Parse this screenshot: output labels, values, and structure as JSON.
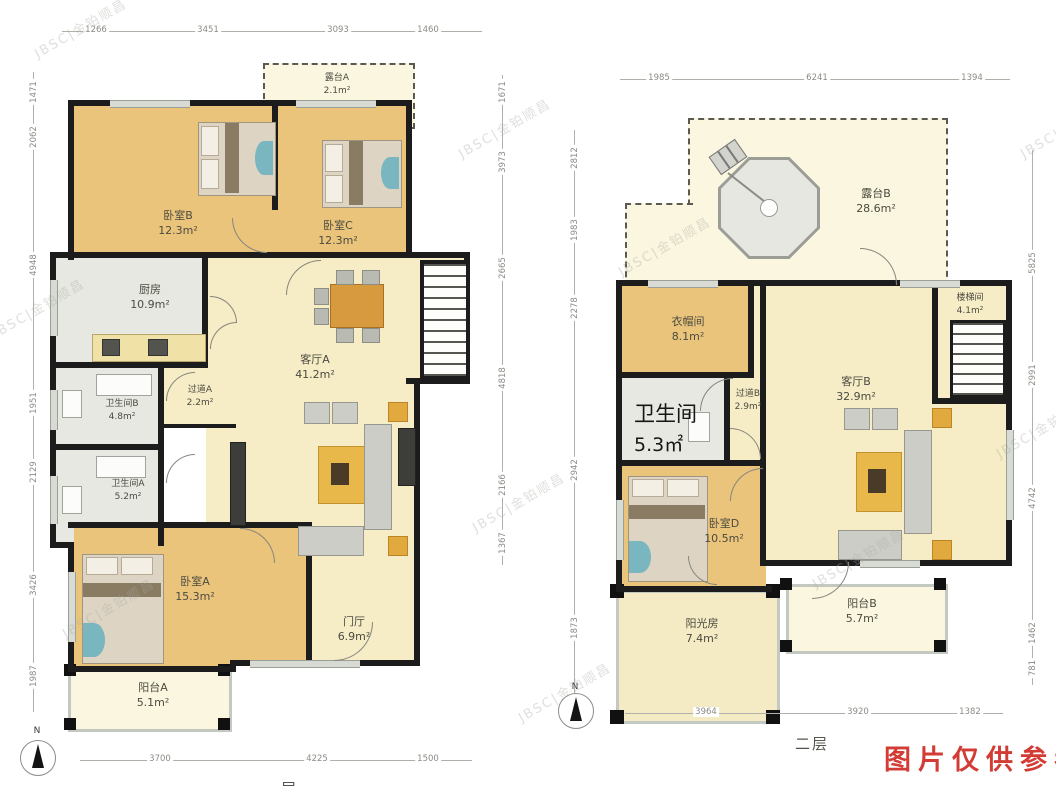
{
  "meta": {
    "floor1_caption": "一层",
    "floor2_caption": "二层",
    "reference_note": "图片仅供参考",
    "watermark": "JBSC|金铂顺昌",
    "north": "N"
  },
  "floor1": {
    "rooms": {
      "terrace_a": {
        "name": "露台A",
        "area": "2.1m²"
      },
      "bedroom_b": {
        "name": "卧室B",
        "area": "12.3m²"
      },
      "bedroom_c": {
        "name": "卧室C",
        "area": "12.3m²"
      },
      "kitchen": {
        "name": "厨房",
        "area": "10.9m²"
      },
      "living_a": {
        "name": "客厅A",
        "area": "41.2m²"
      },
      "corridor_a": {
        "name": "过道A",
        "area": "2.2m²"
      },
      "bath_b": {
        "name": "卫生间B",
        "area": "4.8m²"
      },
      "bath_a": {
        "name": "卫生间A",
        "area": "5.2m²"
      },
      "bedroom_a": {
        "name": "卧室A",
        "area": "15.3m²"
      },
      "foyer": {
        "name": "门厅",
        "area": "6.9m²"
      },
      "balcony_a": {
        "name": "阳台A",
        "area": "5.1m²"
      }
    },
    "dims": {
      "top": [
        "1266",
        "3451",
        "3093",
        "1460"
      ],
      "left": [
        "1471",
        "2062",
        "4948",
        "1951",
        "2129",
        "3426",
        "1987"
      ],
      "right": [
        "1671",
        "3973",
        "2665",
        "4818",
        "2166",
        "1367"
      ],
      "bottom": [
        "3700",
        "4225",
        "1500"
      ]
    }
  },
  "floor2": {
    "rooms": {
      "terrace_b": {
        "name": "露台B",
        "area": "28.6m²"
      },
      "closet": {
        "name": "衣帽间",
        "area": "8.1m²"
      },
      "stair_hall": {
        "name": "楼梯间",
        "area": "4.1m²"
      },
      "bathroom": {
        "name": "卫生间",
        "area": "5.3㎡"
      },
      "corridor_b": {
        "name": "过道B",
        "area": "2.9m²"
      },
      "living_b": {
        "name": "客厅B",
        "area": "32.9m²"
      },
      "bedroom_d": {
        "name": "卧室D",
        "area": "10.5m²"
      },
      "sunroom": {
        "name": "阳光房",
        "area": "7.4m²"
      },
      "balcony_b": {
        "name": "阳台B",
        "area": "5.7m²"
      }
    },
    "dims": {
      "top": [
        "1985",
        "6241",
        "1394"
      ],
      "left": [
        "2812",
        "1983",
        "2278",
        "2942",
        "1873"
      ],
      "right": [
        "5825",
        "2991",
        "4742",
        "1462",
        "781"
      ],
      "bottom": [
        "3964",
        "3920",
        "1382"
      ]
    }
  }
}
